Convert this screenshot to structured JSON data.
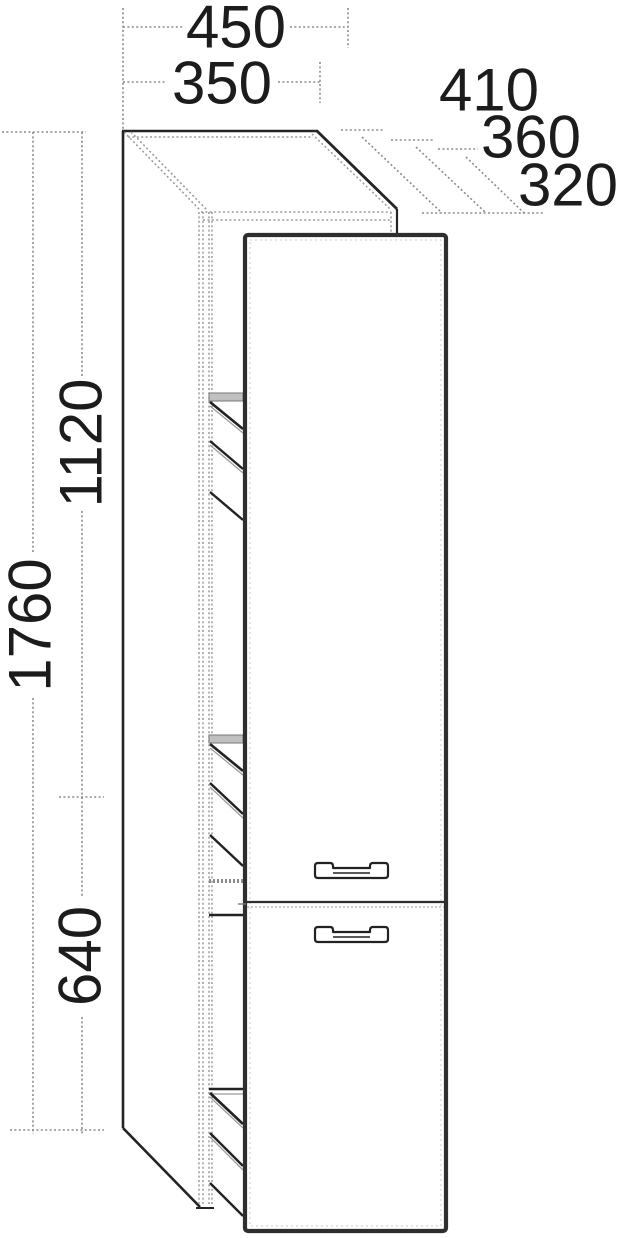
{
  "figure": {
    "description": "tall-cabinet-dimension-drawing",
    "labels": {
      "width_outer": "450",
      "width_inner": "350",
      "depth_a": "410",
      "depth_b": "360",
      "depth_c": "320",
      "height_total": "1760",
      "height_upper": "1120",
      "height_lower": "640"
    },
    "colors": {
      "background": "#ffffff",
      "outline": "#242424",
      "dim": "#8c8c8c",
      "shadow": "#9c9c9c",
      "door_edge": "#2e2e2e",
      "text": "#1c1c1c"
    }
  }
}
